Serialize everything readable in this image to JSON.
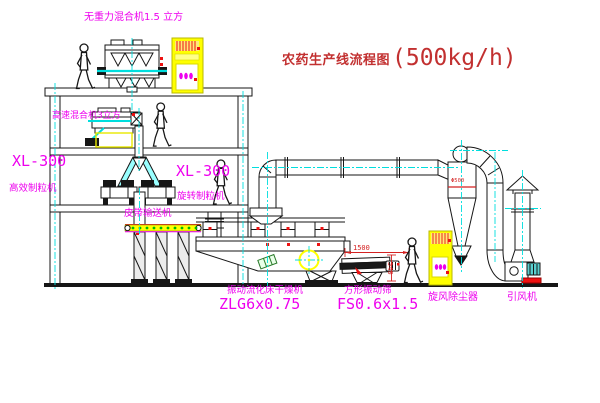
{
  "title": {
    "text": "农药生产线流程图",
    "capacity": "(500kg/h)"
  },
  "equipment_labels": {
    "zero_gravity_mixer": "无重力混合机1.5 立方",
    "high_speed_mixer": "高速混合机3立方",
    "granulator_left_model": "XL-300",
    "granulator_left_name": "高效制粒机",
    "granulator_right_model": "XL-300",
    "granulator_right_name": "旋转制粒机",
    "belt_conveyor": "皮带输送机",
    "dryer_name": "振动流化床干燥机",
    "dryer_model": "ZLG6x0.75",
    "screen_name": "方形振动筛",
    "screen_model": "FS0.6x1.5",
    "cyclone": "旋风除尘器",
    "fan": "引风机"
  },
  "dimensions": {
    "screen_length": "1500",
    "screen_height": "540",
    "cyclone_diameter": "Φ500"
  },
  "colors": {
    "label_magenta": "#ee00ee",
    "title_red": "#c23030",
    "dimension_red": "#d42222",
    "cabinet_yellow": "#ffff00",
    "centerline_cyan": "#00dede",
    "conveyor_dot_green": "#00bb00"
  }
}
